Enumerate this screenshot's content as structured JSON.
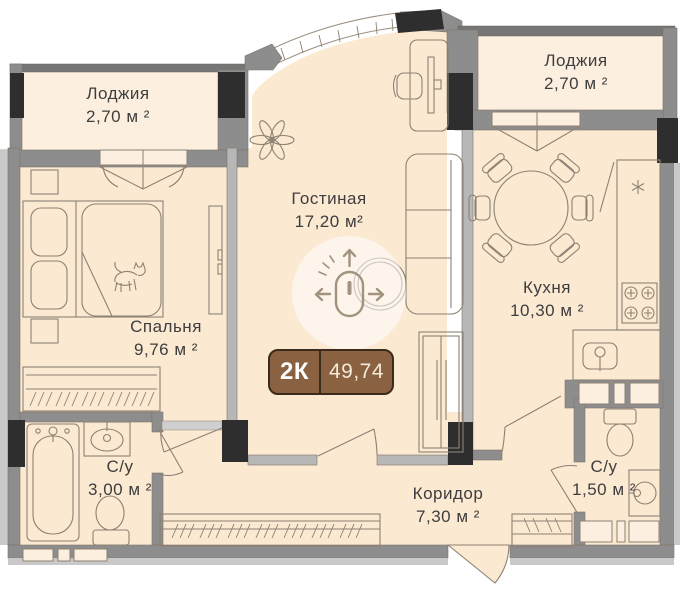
{
  "badge": {
    "type": "2К",
    "area": "49,74"
  },
  "rooms": {
    "loggia_left": {
      "name": "Лоджия",
      "area": "2,70 м ²"
    },
    "loggia_right": {
      "name": "Лоджия",
      "area": "2,70 м ²"
    },
    "living": {
      "name": "Гостиная",
      "area": "17,20 м²"
    },
    "kitchen": {
      "name": "Кухня",
      "area": "10,30 м ²"
    },
    "bedroom": {
      "name": "Спальня",
      "area": "9,76 м ²"
    },
    "bath_main": {
      "name": "С/у",
      "area": "3,00 м ²"
    },
    "bath_guest": {
      "name": "С/у",
      "area": "1,50 м ²"
    },
    "corridor": {
      "name": "Коридор",
      "area": "7,30 м ²"
    }
  },
  "colors": {
    "floor": "#fbe9d2",
    "floor_light": "#fcefdf",
    "wall_gray": "#8d8d8d",
    "wall_dark": "#767676",
    "wall_light": "#c9c9c9",
    "wall_thin": "#b7b7b7",
    "column": "#2e2e2e",
    "line_brown": "#8d8173",
    "text": "#3e3e3e",
    "badge_bg": "#8a6141",
    "badge_border": "#3b2b1c",
    "badge_text": "#ffffff",
    "badge_area_text": "#f4ead9",
    "mouse": "#a2937f"
  }
}
